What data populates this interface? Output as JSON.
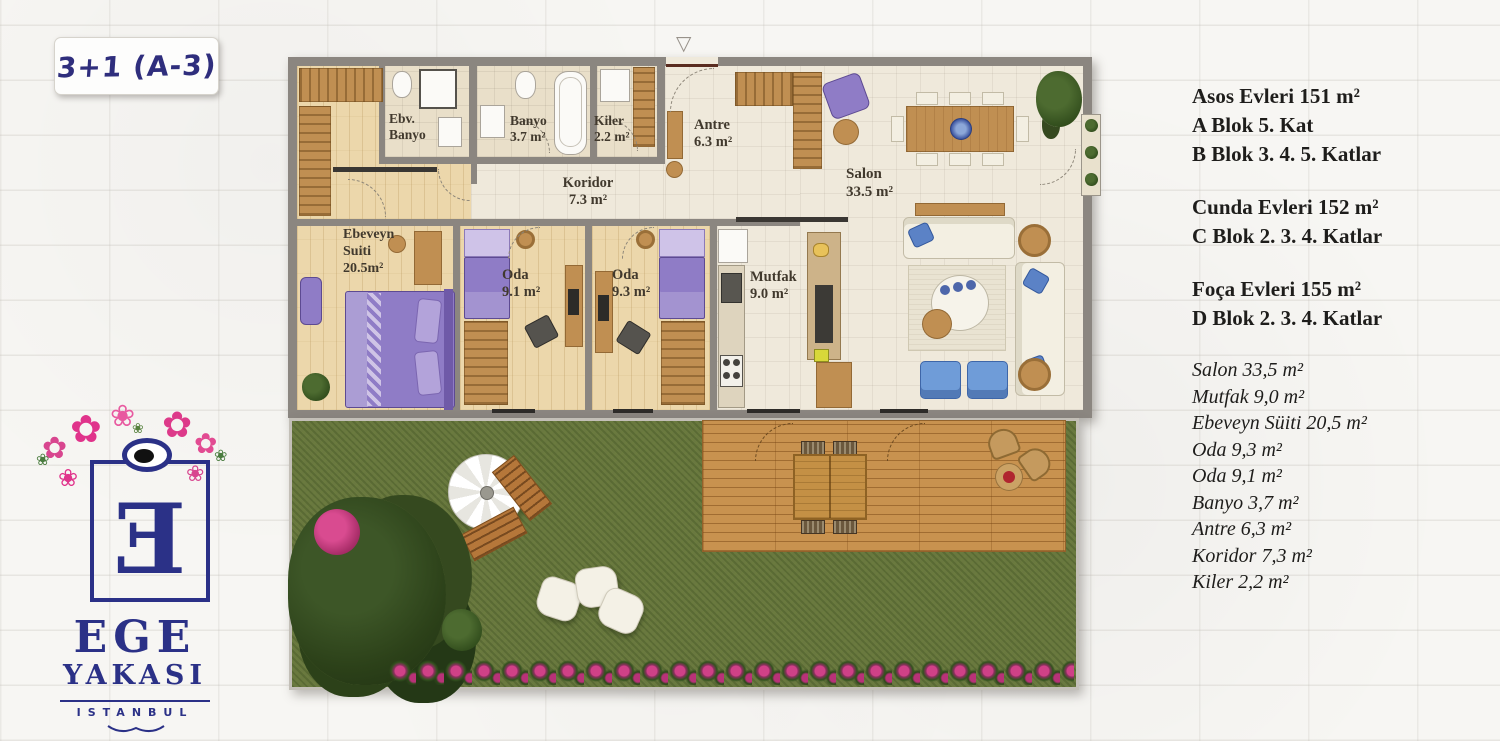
{
  "badge": {
    "label": "3+1 (A-3)"
  },
  "logo": {
    "word1": "EGE",
    "word2": "YAKASI",
    "word3": "ISTANBUL",
    "monogram": "Ǝ"
  },
  "info": {
    "projects": [
      {
        "title": "Asos Evleri 151 m²",
        "lines": [
          "A Blok 5. Kat",
          "B Blok 3. 4. 5. Katlar"
        ]
      },
      {
        "title": "Cunda Evleri 152 m²",
        "lines": [
          "C Blok 2. 3. 4. Katlar"
        ]
      },
      {
        "title": "Foça Evleri 155 m²",
        "lines": [
          "D Blok 2. 3. 4. Katlar"
        ]
      }
    ],
    "room_list": [
      "Salon 33,5 m²",
      "Mutfak 9,0 m²",
      "Ebeveyn Süiti 20,5 m²",
      "Oda 9,3 m²",
      "Oda 9,1 m²",
      "Banyo 3,7 m²",
      "Antre 6,3 m²",
      "Koridor 7,3 m²",
      "Kiler 2,2 m²"
    ]
  },
  "plan": {
    "labels": {
      "ebv_banyo": "Ebv.\nBanyo",
      "banyo": "Banyo\n3.7 m²",
      "kiler": "Kiler\n2.2 m²",
      "antre": "Antre\n6.3 m²",
      "koridor": "Koridor\n7.3 m²",
      "salon": "Salon\n33.5 m²",
      "mutfak": "Mutfak\n9.0 m²",
      "ebeveyn": "Ebeveyn\nSuiti\n20.5m²",
      "oda_a": "Oda\n9.1 m²",
      "oda_b": "Oda\n9.3 m²"
    }
  },
  "colors": {
    "accent_navy": "#2b3187",
    "flower_pink": "#e0338b",
    "wall_gray": "#8b8680",
    "grass_green": "#69783f",
    "furniture_wood": "#c08f52",
    "bed_purple": "#8f7cc6"
  }
}
